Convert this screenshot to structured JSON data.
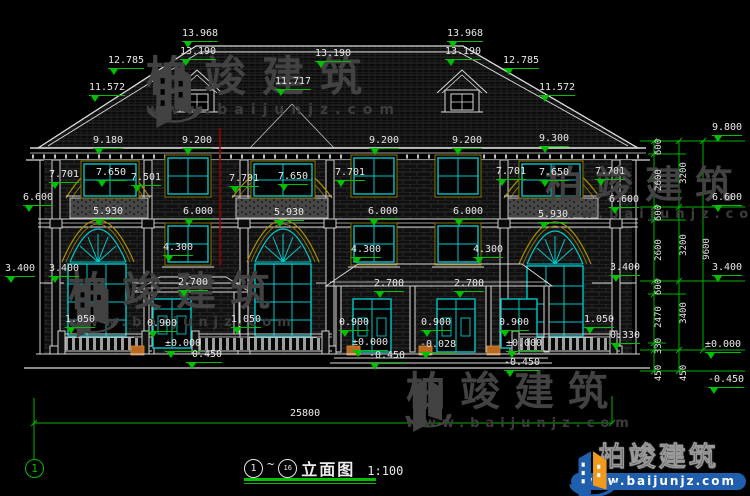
{
  "page": {
    "width": 750,
    "height": 496,
    "background": "#000000"
  },
  "colors": {
    "dimension_green": "#00c000",
    "window_cyan": "#00c8c8",
    "trim_yellow": "#a89000",
    "line_white": "#d8d8d8",
    "section_red": "#a00000",
    "planter_orange": "#b96a1e",
    "logo_blue": "#1f5fae",
    "logo_orange": "#f0991d",
    "watermark_gray": "#424242"
  },
  "watermark": {
    "name": "柏竣建筑",
    "url": "www.baijunjz.com"
  },
  "logo": {
    "name": "柏竣建筑",
    "url": "www.baijunjz.com"
  },
  "title_block": {
    "axis_start": "1",
    "tilde": "~",
    "axis_end": "16",
    "title": "立面图",
    "scale": "1:100"
  },
  "axis_bubble": {
    "label": "1"
  },
  "labels": {
    "overall": {
      "text": "25800"
    },
    "levels": [
      {
        "t": "13.968",
        "x": 200,
        "y": 29
      },
      {
        "t": "13.190",
        "x": 198,
        "y": 47
      },
      {
        "t": "12.785",
        "x": 126,
        "y": 56
      },
      {
        "t": "11.572",
        "x": 107,
        "y": 83
      },
      {
        "t": "13.190",
        "x": 333,
        "y": 49
      },
      {
        "t": "11.717",
        "x": 293,
        "y": 77
      },
      {
        "t": "13.968",
        "x": 465,
        "y": 29
      },
      {
        "t": "13.190",
        "x": 463,
        "y": 47
      },
      {
        "t": "12.785",
        "x": 521,
        "y": 56
      },
      {
        "t": "11.572",
        "x": 557,
        "y": 83
      },
      {
        "t": "9.180",
        "x": 108,
        "y": 136
      },
      {
        "t": "9.200",
        "x": 197,
        "y": 136
      },
      {
        "t": "9.200",
        "x": 384,
        "y": 136
      },
      {
        "t": "9.200",
        "x": 467,
        "y": 136
      },
      {
        "t": "9.300",
        "x": 554,
        "y": 134
      },
      {
        "t": "7.701",
        "x": 64,
        "y": 170
      },
      {
        "t": "7.650",
        "x": 111,
        "y": 168
      },
      {
        "t": "7.501",
        "x": 146,
        "y": 173
      },
      {
        "t": "7.701",
        "x": 244,
        "y": 174
      },
      {
        "t": "7.650",
        "x": 293,
        "y": 172
      },
      {
        "t": "7.701",
        "x": 350,
        "y": 168
      },
      {
        "t": "7.701",
        "x": 511,
        "y": 167
      },
      {
        "t": "7.650",
        "x": 554,
        "y": 168
      },
      {
        "t": "7.701",
        "x": 610,
        "y": 167
      },
      {
        "t": "6.600",
        "x": 38,
        "y": 193
      },
      {
        "t": "5.930",
        "x": 108,
        "y": 207
      },
      {
        "t": "6.000",
        "x": 198,
        "y": 207
      },
      {
        "t": "5.930",
        "x": 289,
        "y": 208
      },
      {
        "t": "6.000",
        "x": 383,
        "y": 207
      },
      {
        "t": "6.000",
        "x": 468,
        "y": 207
      },
      {
        "t": "5.930",
        "x": 553,
        "y": 210
      },
      {
        "t": "6.600",
        "x": 624,
        "y": 195
      },
      {
        "t": "4.300",
        "x": 178,
        "y": 243
      },
      {
        "t": "4.300",
        "x": 366,
        "y": 245
      },
      {
        "t": "4.300",
        "x": 488,
        "y": 245
      },
      {
        "t": "3.400",
        "x": 20,
        "y": 264
      },
      {
        "t": "3.400",
        "x": 64,
        "y": 264
      },
      {
        "t": "3.400",
        "x": 625,
        "y": 263
      },
      {
        "t": "2.700",
        "x": 193,
        "y": 278
      },
      {
        "t": "2.700",
        "x": 389,
        "y": 279
      },
      {
        "t": "2.700",
        "x": 469,
        "y": 279
      },
      {
        "t": "1.050",
        "x": 80,
        "y": 315
      },
      {
        "t": "0.900",
        "x": 162,
        "y": 319
      },
      {
        "t": "1.050",
        "x": 246,
        "y": 315
      },
      {
        "t": "0.900",
        "x": 354,
        "y": 318
      },
      {
        "t": "0.900",
        "x": 436,
        "y": 318
      },
      {
        "t": "0.900",
        "x": 514,
        "y": 318
      },
      {
        "t": "1.050",
        "x": 599,
        "y": 315
      },
      {
        "t": "0.330",
        "x": 625,
        "y": 331
      },
      {
        "t": "±0.000",
        "x": 183,
        "y": 339
      },
      {
        "t": "-0.450",
        "x": 204,
        "y": 350
      },
      {
        "t": "±0.000",
        "x": 370,
        "y": 338
      },
      {
        "t": "-0.450",
        "x": 387,
        "y": 351
      },
      {
        "t": "-0.028",
        "x": 438,
        "y": 340
      },
      {
        "t": "±0.000",
        "x": 524,
        "y": 339
      },
      {
        "t": "-0.450",
        "x": 522,
        "y": 358
      },
      {
        "t": "9.800",
        "x": 727,
        "y": 123
      },
      {
        "t": "6.600",
        "x": 727,
        "y": 193
      },
      {
        "t": "3.400",
        "x": 727,
        "y": 263
      },
      {
        "t": "±0.000",
        "x": 723,
        "y": 340
      },
      {
        "t": "-0.450",
        "x": 726,
        "y": 375
      }
    ],
    "chain": [
      {
        "t": "600",
        "x": 659,
        "y": 147
      },
      {
        "t": "2600",
        "x": 659,
        "y": 180
      },
      {
        "t": "600",
        "x": 659,
        "y": 213
      },
      {
        "t": "2600",
        "x": 659,
        "y": 250
      },
      {
        "t": "600",
        "x": 659,
        "y": 287
      },
      {
        "t": "2470",
        "x": 659,
        "y": 317
      },
      {
        "t": "330",
        "x": 659,
        "y": 346
      },
      {
        "t": "450",
        "x": 659,
        "y": 373
      },
      {
        "t": "3200",
        "x": 684,
        "y": 173
      },
      {
        "t": "3200",
        "x": 684,
        "y": 245
      },
      {
        "t": "3400",
        "x": 684,
        "y": 313
      },
      {
        "t": "450",
        "x": 684,
        "y": 373
      },
      {
        "t": "9600",
        "x": 707,
        "y": 249
      }
    ]
  }
}
